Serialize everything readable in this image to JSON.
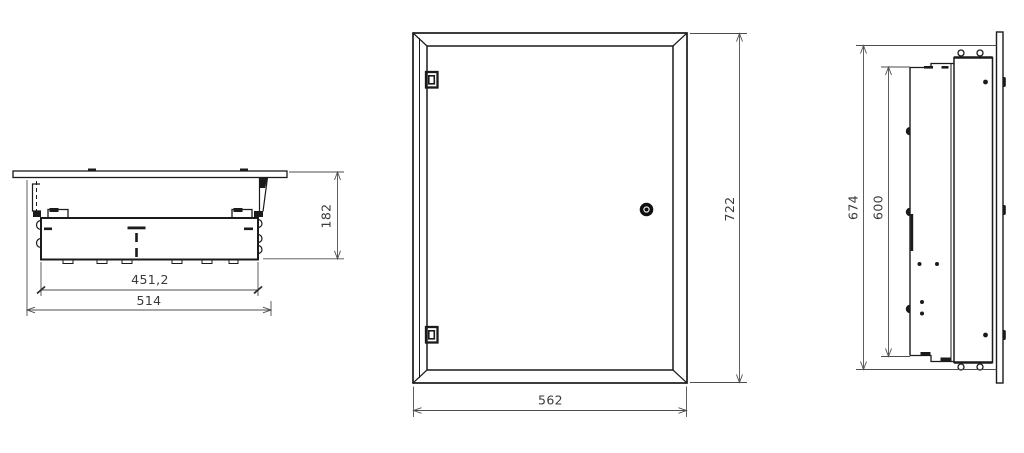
{
  "drawing": {
    "background": "#ffffff",
    "geometry_color": "#1b1b1b",
    "dimension_line_color": "#4d4d4d",
    "dimension_text_color": "#3a3a3a",
    "views": {
      "top": {
        "dims": {
          "inner_width": "451,2",
          "overall_width": "514",
          "depth": "182"
        }
      },
      "front": {
        "dims": {
          "width": "562",
          "height": "722"
        }
      },
      "side": {
        "dims": {
          "overall_height": "674",
          "inner_height": "600"
        }
      }
    }
  }
}
